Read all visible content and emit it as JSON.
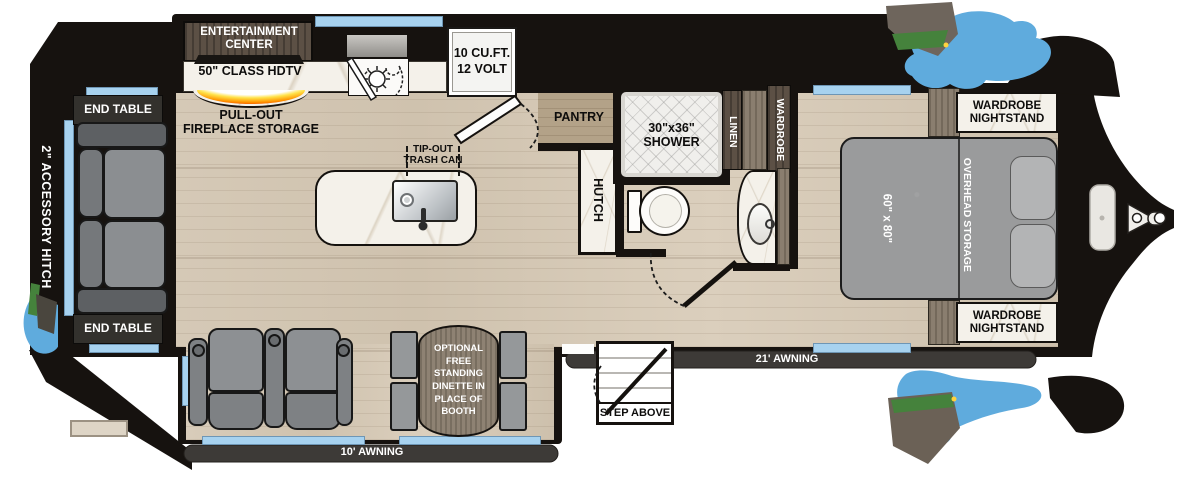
{
  "plan": {
    "rear": {
      "accessory_hitch": "2\" ACCESSORY HITCH",
      "end_table_top": "END TABLE",
      "end_table_bottom": "END TABLE"
    },
    "kitchen": {
      "entertainment": "ENTERTAINMENT CENTER",
      "tv": "50\" CLASS HDTV",
      "fireplace": "PULL-OUT FIREPLACE STORAGE",
      "refrigerator": "10 CU.FT. 12 VOLT",
      "trash": "TIP-OUT TRASH CAN",
      "pantry": "PANTRY",
      "hutch": "HUTCH"
    },
    "bath": {
      "shower": "30\"x36\" SHOWER",
      "linen": "LINEN",
      "wardrobe": "WARDROBE"
    },
    "bedroom": {
      "nightstand_top": "WARDROBE NIGHTSTAND",
      "nightstand_bottom": "WARDROBE NIGHTSTAND",
      "bed_size": "60\" x 80\"",
      "overhead": "OVERHEAD STORAGE"
    },
    "living": {
      "dinette_note": "OPTIONAL FREE STANDING DINETTE IN PLACE OF BOOTH"
    },
    "exterior": {
      "awning_front": "21' AWNING",
      "awning_rear": "10' AWNING",
      "step": "STEP ABOVE"
    }
  },
  "colors": {
    "outline": "#16120f",
    "floor": "#d2c6b3",
    "floor_pantry": "#b3a288",
    "window": "#a7d2ef",
    "awning_bar": "#3d3a37",
    "marble": "#f4f1ea",
    "wood_cabinet": "#5c5045",
    "fabric_gray": "#8b8e91",
    "fireplace_orange": "#ff8a00",
    "splash_blue": "#5fabdd",
    "art_green": "#45823c",
    "art_brown": "#6b6156"
  }
}
